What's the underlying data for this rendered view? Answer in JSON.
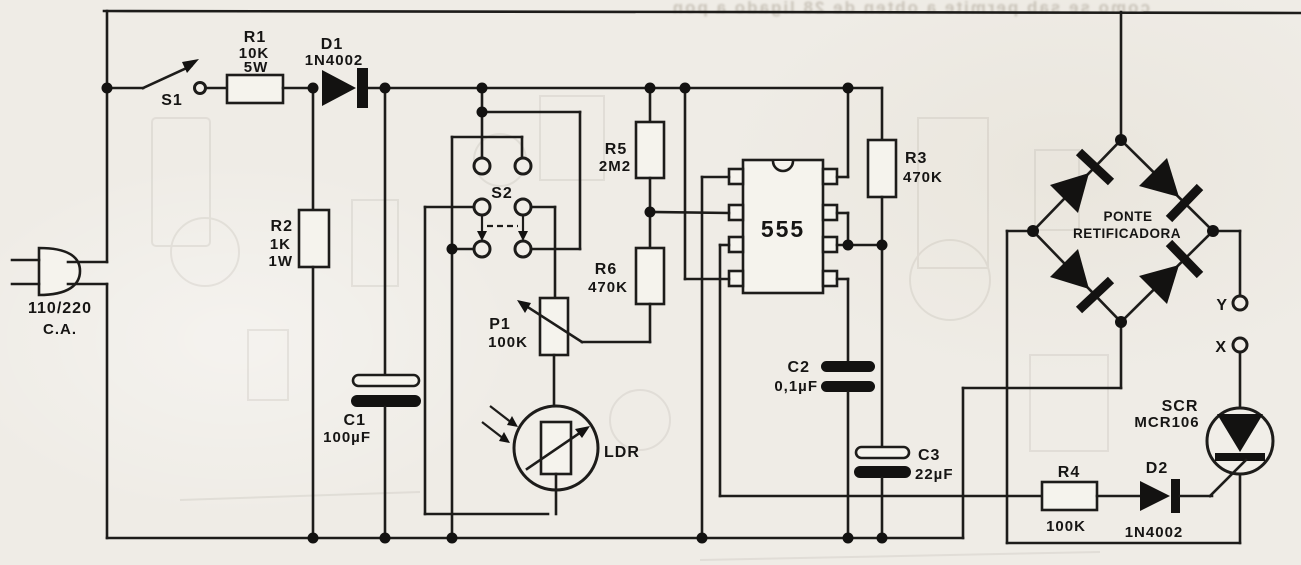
{
  "diagram": {
    "kind": "electronic-schematic",
    "description": "555-based light-controlled AC switch schematic (scanned)",
    "ink_color": "#1d1c1a",
    "paper_color": "#efece6"
  },
  "components": {
    "ac_supply": {
      "line1": "110/220",
      "line2": "C.A."
    },
    "s1": {
      "ref": "S1"
    },
    "r1": {
      "ref": "R1",
      "value": "10K",
      "power": "5W"
    },
    "d1": {
      "ref": "D1",
      "part": "1N4002"
    },
    "r2": {
      "ref": "R2",
      "value": "1K",
      "power": "1W"
    },
    "c1": {
      "ref": "C1",
      "value": "100µF"
    },
    "s2": {
      "ref": "S2"
    },
    "p1": {
      "ref": "P1",
      "value": "100K"
    },
    "ldr": {
      "ref": "LDR"
    },
    "r5": {
      "ref": "R5",
      "value": "2M2"
    },
    "r6": {
      "ref": "R6",
      "value": "470K"
    },
    "ic1": {
      "ref": "555"
    },
    "r3": {
      "ref": "R3",
      "value": "470K"
    },
    "c2": {
      "ref": "C2",
      "value": "0,1µF"
    },
    "c3": {
      "ref": "C3",
      "value": "22µF"
    },
    "bridge": {
      "line1": "PONTE",
      "line2": "RETIFICADORA"
    },
    "terminal_y": {
      "ref": "Y"
    },
    "terminal_x": {
      "ref": "X"
    },
    "scr": {
      "ref": "SCR",
      "part": "MCR106"
    },
    "r4": {
      "ref": "R4",
      "value": "100K"
    },
    "d2": {
      "ref": "D2",
      "part": "1N4002"
    }
  },
  "artifacts": {
    "bleedthrough_text": "como se sab  permite a obten   de 28   ligado a pon"
  }
}
